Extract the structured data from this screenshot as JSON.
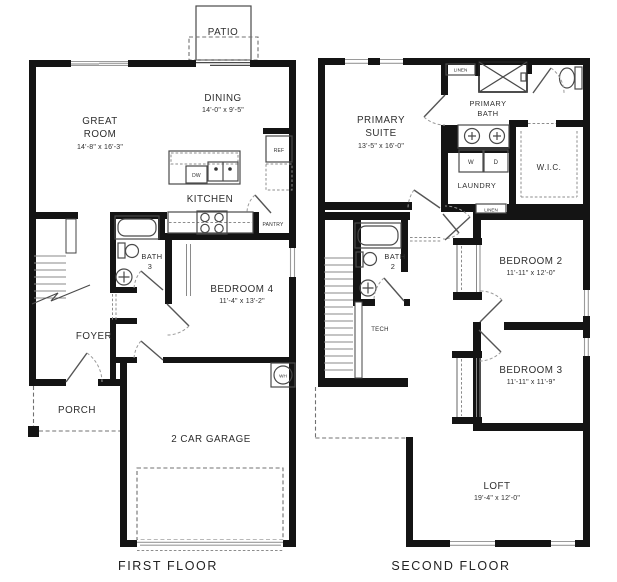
{
  "first_floor": {
    "title": "FIRST FLOOR",
    "rooms": {
      "patio": {
        "name": "PATIO"
      },
      "dining": {
        "name": "DINING",
        "dims": "14'-0\" x 9'-5\""
      },
      "great_room": {
        "line1": "GREAT",
        "line2": "ROOM",
        "dims": "14'-8\" x 16'-3\""
      },
      "kitchen": {
        "name": "KITCHEN"
      },
      "bath3": {
        "line1": "BATH",
        "line2": "3"
      },
      "bedroom4": {
        "name": "BEDROOM 4",
        "dims": "11'-4\" x 13'-2\""
      },
      "foyer": {
        "name": "FOYER"
      },
      "porch": {
        "name": "PORCH"
      },
      "garage": {
        "name": "2 CAR GARAGE"
      }
    },
    "fixtures": {
      "ref": "REF",
      "dishwasher": "DW",
      "pantry": "PANTRY",
      "water_heater": "WH"
    }
  },
  "second_floor": {
    "title": "SECOND FLOOR",
    "rooms": {
      "primary_suite": {
        "line1": "PRIMARY",
        "line2": "SUITE",
        "dims": "13'-5\" x 16'-0\""
      },
      "primary_bath": {
        "line1": "PRIMARY",
        "line2": "BATH"
      },
      "laundry": {
        "name": "LAUNDRY"
      },
      "wic": {
        "name": "W.I.C."
      },
      "bath2": {
        "line1": "BATH",
        "line2": "2"
      },
      "tech": {
        "name": "TECH"
      },
      "bedroom2": {
        "name": "BEDROOM 2",
        "dims": "11'-11\" x 12'-0\""
      },
      "bedroom3": {
        "name": "BEDROOM 3",
        "dims": "11'-11\" x 11'-9\""
      },
      "loft": {
        "name": "LOFT",
        "dims": "19'-4\" x 12'-0\""
      }
    },
    "fixtures": {
      "linen_top": "LINEN",
      "linen_hall": "LINEN",
      "washer": "W",
      "dryer": "D"
    }
  }
}
